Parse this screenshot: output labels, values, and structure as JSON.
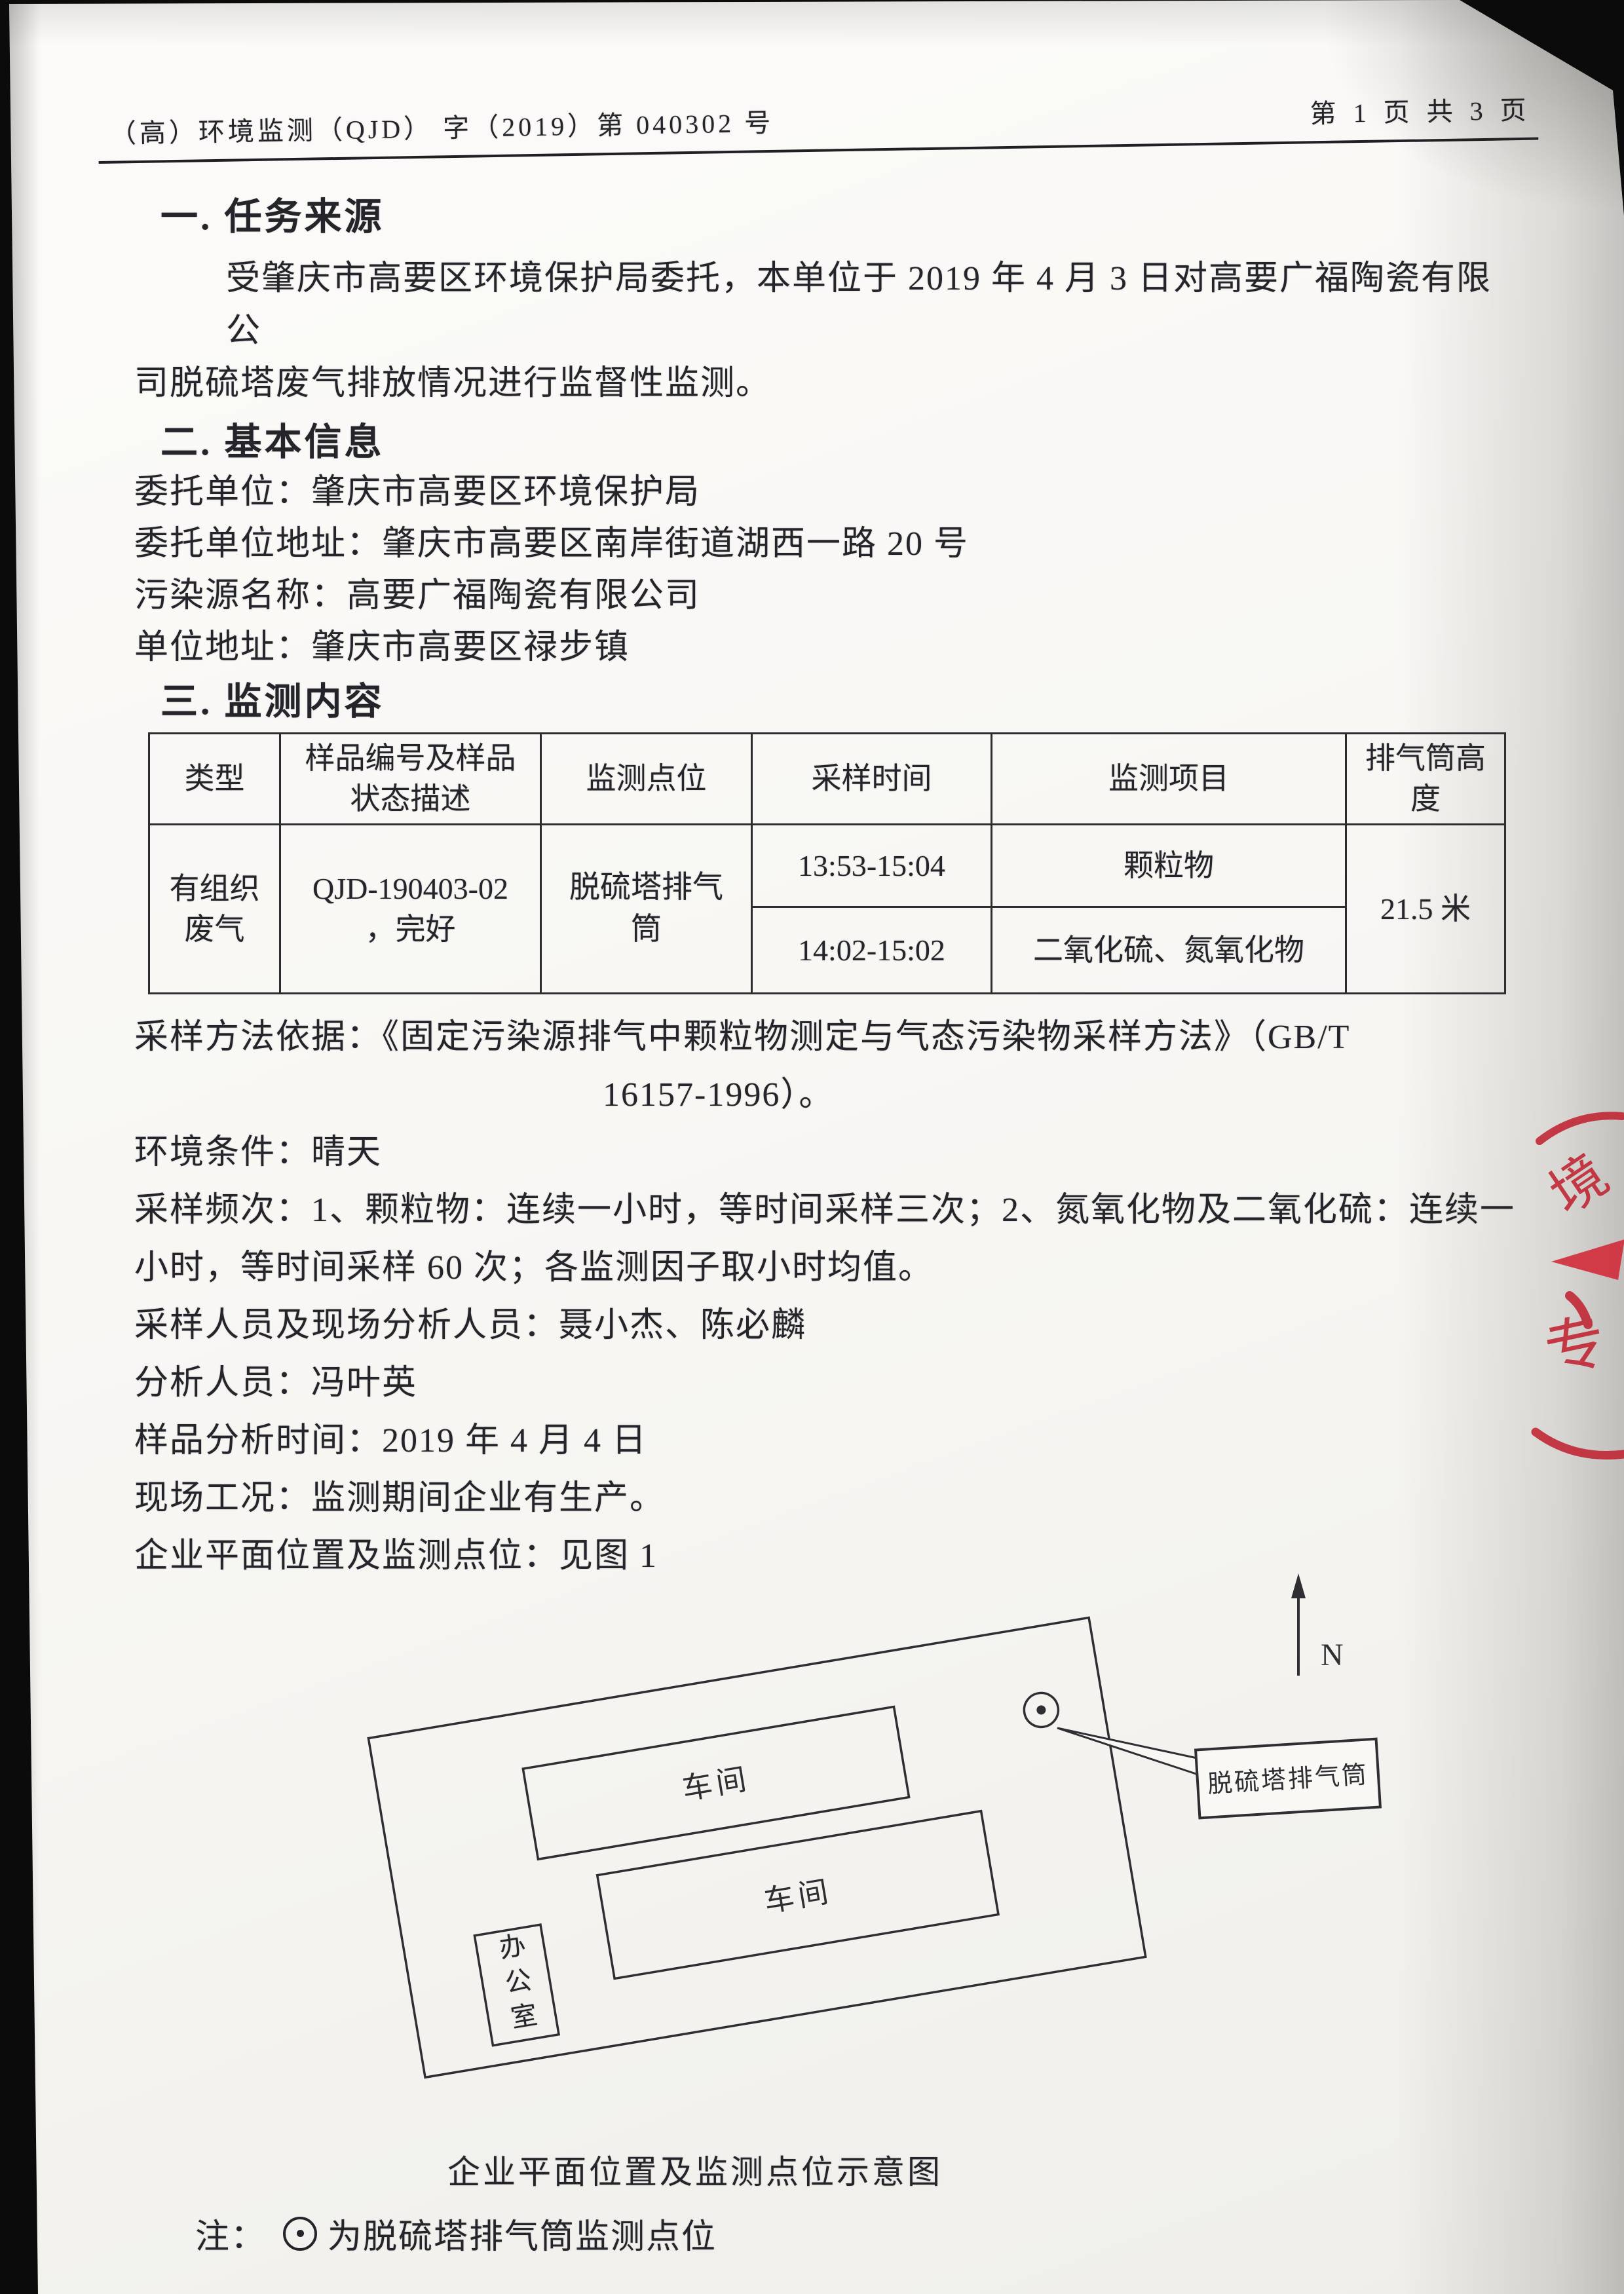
{
  "header": {
    "code": "（高）环境监测（QJD） 字（2019）第 040302 号",
    "page_info": "第 1 页 共 3 页"
  },
  "section1": {
    "title": "一. 任务来源",
    "lines": [
      "受肇庆市高要区环境保护局委托，本单位于 2019 年 4 月 3 日对高要广福陶瓷有限公",
      "司脱硫塔废气排放情况进行监督性监测。"
    ]
  },
  "section2": {
    "title": "二. 基本信息",
    "items": [
      {
        "label": "委托单位：",
        "value": "肇庆市高要区环境保护局"
      },
      {
        "label": "委托单位地址：",
        "value": "肇庆市高要区南岸街道湖西一路 20 号"
      },
      {
        "label": "污染源名称：",
        "value": "高要广福陶瓷有限公司"
      },
      {
        "label": "单位地址：",
        "value": "肇庆市高要区禄步镇"
      }
    ]
  },
  "section3": {
    "title": "三. 监测内容"
  },
  "table": {
    "headers": [
      "类型",
      "样品编号及样品状态描述",
      "监测点位",
      "采样时间",
      "监测项目",
      "排气筒高度"
    ],
    "row": {
      "type": "有组织废气",
      "sample_line1": "QJD-190403-02",
      "sample_line2": "，完好",
      "point": "脱硫塔排气筒",
      "time1": "13:53-15:04",
      "item1": "颗粒物",
      "time2": "14:02-15:02",
      "item2": "二氧化硫、氮氧化物",
      "height": "21.5 米"
    }
  },
  "lines": [
    "采样方法依据：《固定污染源排气中颗粒物测定与气态污染物采样方法》（GB/T",
    "16157-1996）。",
    "环境条件：晴天",
    "采样频次：1、颗粒物：连续一小时，等时间采样三次；2、氮氧化物及二氧化硫：连续一",
    "小时，等时间采样 60 次；各监测因子取小时均值。",
    "采样人员及现场分析人员：聂小杰、陈必麟",
    "分析人员：冯叶英",
    "样品分析时间：2019 年 4 月 4 日",
    "现场工况：监测期间企业有生产。",
    "企业平面位置及监测点位：见图 1"
  ],
  "figure": {
    "workshop_top": "车间",
    "workshop_bottom": "车间",
    "office": "办公室",
    "north_label": "N",
    "callout_label": "脱硫塔排气筒",
    "caption": "企业平面位置及监测点位示意图",
    "note_prefix": "注：",
    "note_symbol": "⊙",
    "note_text": "为脱硫塔排气筒监测点位"
  },
  "stamp": {
    "seal_char_1": "境",
    "seal_char_2": "专",
    "seal_color": "#c02331"
  }
}
